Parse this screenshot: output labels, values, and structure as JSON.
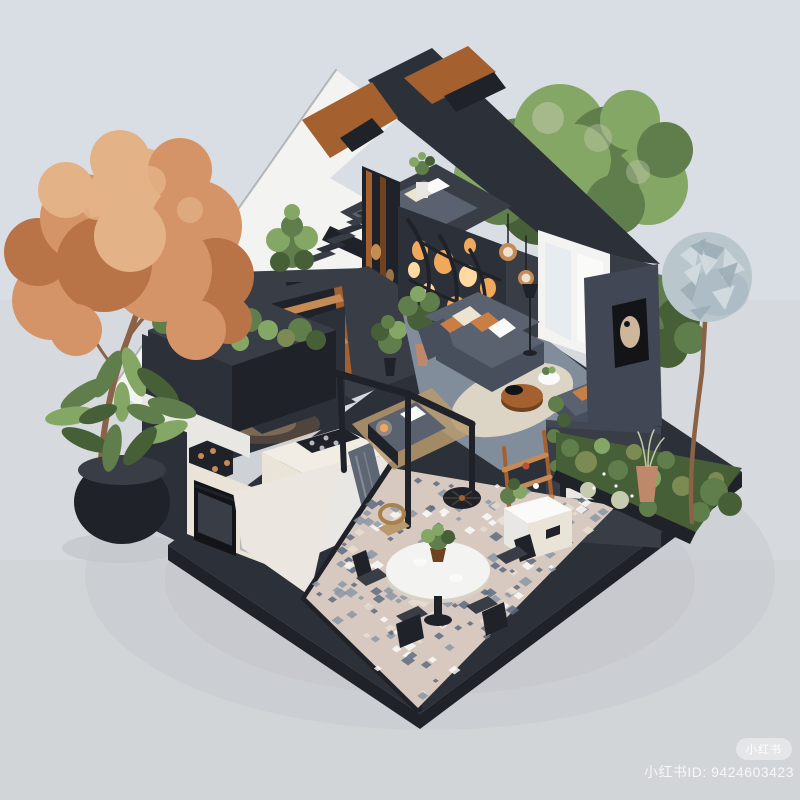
{
  "image": {
    "alt": "Isometric cutaway 3D render of a modern two-storey home: kitchen, living room, loft bedroom, balcony, pergola day-bed, mosaic patio with round dining table, roof garden, autumn tree, green trees and a spherical topiary tree on a light grey background"
  },
  "watermark": {
    "badge_label": "小红书",
    "id_text": "小红书ID: 9424603423"
  },
  "palette": {
    "bgTop": "#d9dee5",
    "bgMid": "#d6d9de",
    "bgBottom": "#d2d5d8",
    "shadow": "#b7bbc1",
    "charcoal": "#2c3038",
    "charcoalDark": "#1f2228",
    "charcoalMid": "#383d46",
    "slateWall": "#414754",
    "whiteRoof": "#f3f3f1",
    "whiteSoft": "#e8e7e4",
    "white": "#fafaf8",
    "creamCounter": "#f2ede4",
    "creamCabinet": "#e9e3d8",
    "kitchenFloor": "#ebe6df",
    "wood": "#a5602f",
    "woodDark": "#6f4220",
    "woodLight": "#c58a55",
    "amber": "#f0a95c",
    "amberGlow": "#ffd9a0",
    "sofa": "#5a6270",
    "sofaDark": "#474e5c",
    "pillowCream": "#ece4d0",
    "pillowOrange": "#c77f45",
    "rug": "#dcd5c5",
    "carpet": "#828d9b",
    "green": "#5f7e4b",
    "greenLight": "#85a766",
    "greenDark": "#465f37",
    "olive": "#7c8a54",
    "paleGrass": "#c6cbb0",
    "autumn": "#d49468",
    "autumnLight": "#e3b286",
    "autumnDark": "#b87347",
    "trunk": "#8a6246",
    "ball": "#b9c7cd",
    "ballLight": "#d3dce0",
    "ballDark": "#9cadb6",
    "mosaic": "#d8c9c0",
    "tileBlue": "#8b97a4",
    "tileDark": "#5d6b7c",
    "tileCream": "#e8dfd1",
    "terracotta": "#c0886a",
    "glass": "#e7ecf0",
    "glassDark": "#515b6a",
    "black": "#131418",
    "silver": "#b6bac0",
    "artBeige": "#cdb69b",
    "rattan": "#b99a6e"
  }
}
